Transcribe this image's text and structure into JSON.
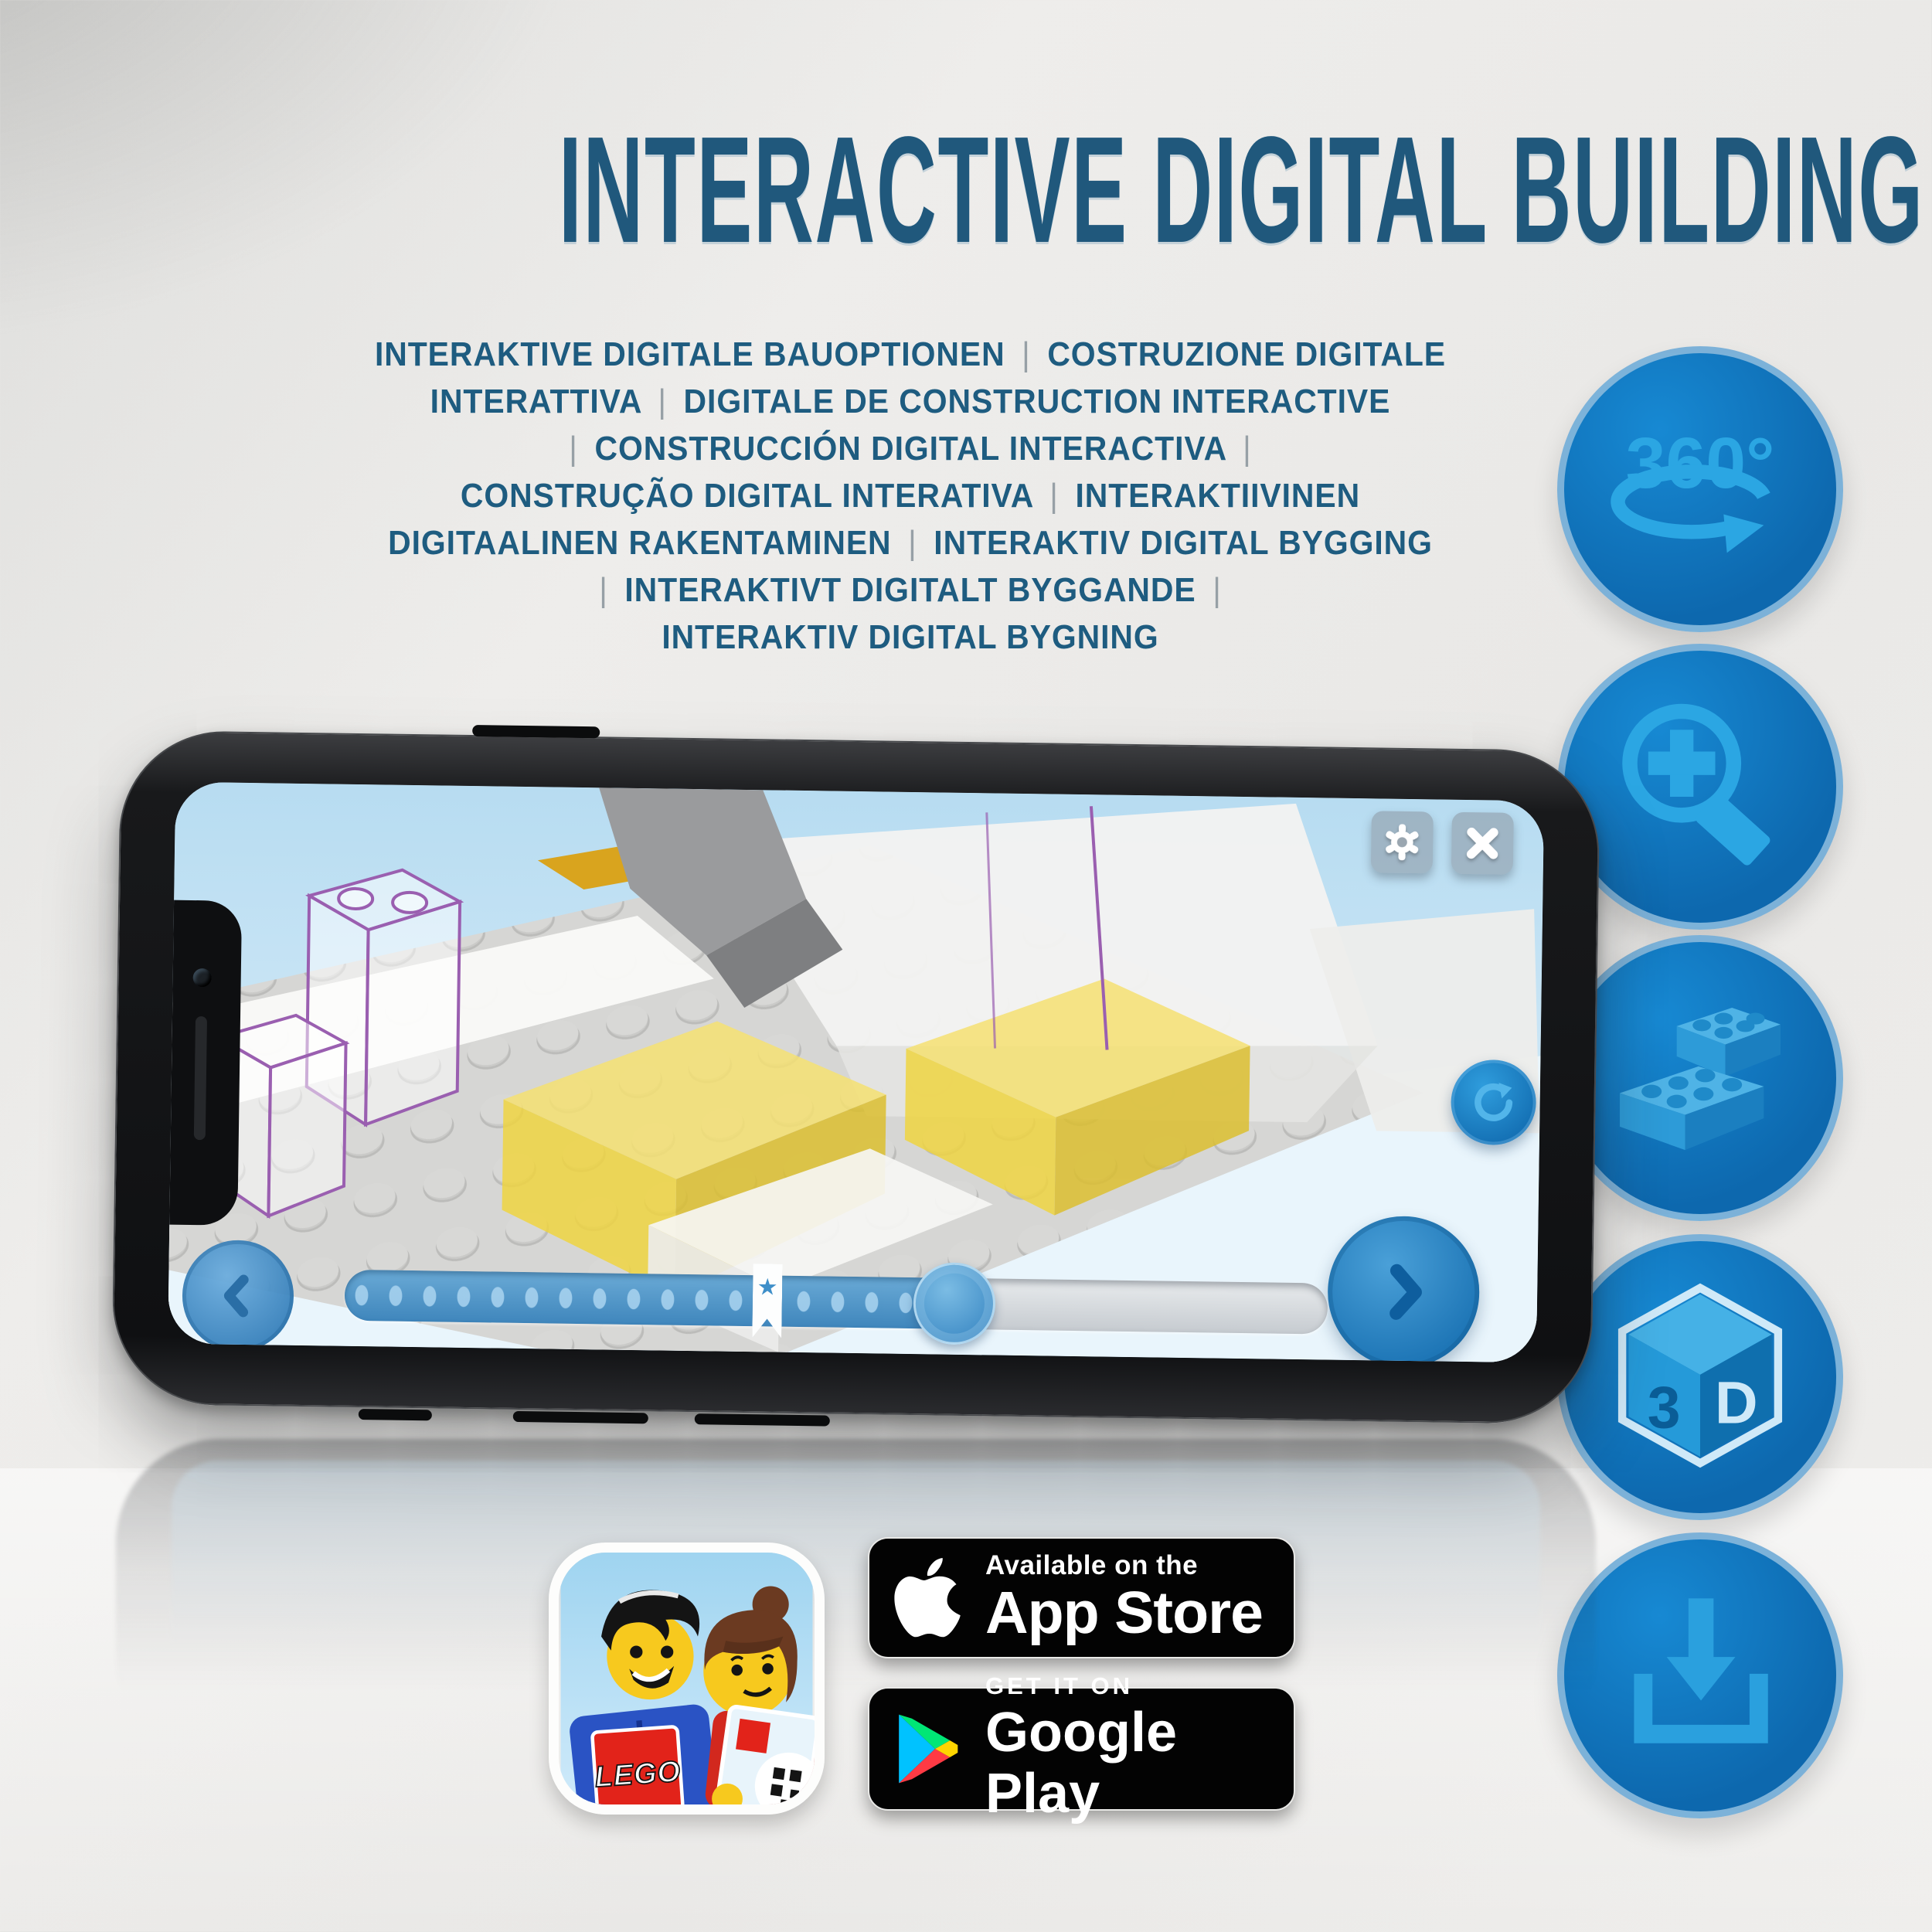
{
  "header": {
    "title": "INTERACTIVE DIGITAL BUILDING"
  },
  "subtitle": {
    "lines": [
      "INTERAKTIVE DIGITALE BAUOPTIONEN | COSTRUZIONE DIGITALE",
      "INTERATTIVA | DIGITALE DE CONSTRUCTION INTERACTIVE",
      "| CONSTRUCCIÓN DIGITAL INTERACTIVA |",
      "CONSTRUÇÃO DIGITAL INTERATIVA | INTERAKTIIVINEN",
      "DIGITAALINEN RAKENTAMINEN | INTERAKTIV DIGITAL BYGGING",
      "| INTERAKTIVT DIGITALT BYGGANDE |",
      "INTERAKTIV DIGITAL BYGNING"
    ]
  },
  "feature_icons": [
    {
      "id": "rotate-360-icon",
      "label": "360°"
    },
    {
      "id": "zoom-in-icon",
      "label": ""
    },
    {
      "id": "lego-bricks-icon",
      "label": ""
    },
    {
      "id": "3d-view-icon",
      "face_left": "3",
      "face_right": "D"
    },
    {
      "id": "download-icon",
      "label": ""
    }
  ],
  "phone": {
    "app_ui": {
      "slider": {
        "progress_percent": 62,
        "bookmark_percent": 43
      },
      "buttons": [
        "settings-gear",
        "close",
        "rotate-step",
        "previous-step",
        "next-step"
      ]
    }
  },
  "badges": {
    "lego_app_icon": {
      "logo_text": "LEGO"
    },
    "app_store": {
      "line1": "Available on the",
      "line2": "App Store"
    },
    "google_play": {
      "line1": "GET IT ON",
      "line2": "Google Play"
    }
  },
  "colors": {
    "title_blue": "#20587c",
    "pipe_gray": "#97a0a6",
    "circle_fill": "#0d68ae",
    "icon_glyph_blue": "#2ba6e3",
    "badge_black": "#030303",
    "brick_yellow": "#f2d84a",
    "ghost_outline_purple": "#9a5fb0"
  }
}
